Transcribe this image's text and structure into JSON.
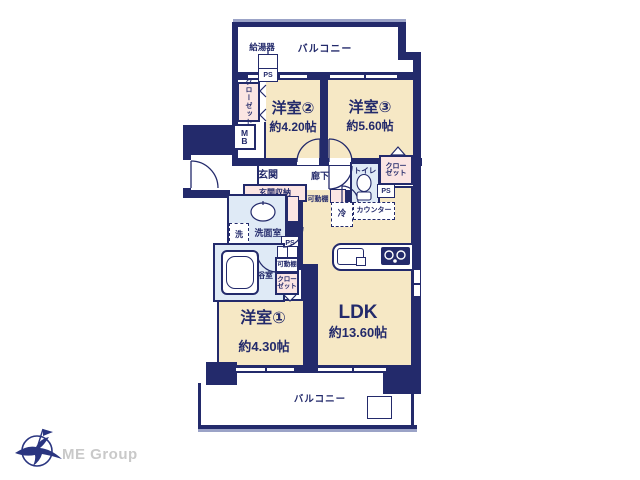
{
  "colors": {
    "wall_navy": "#232a6b",
    "room_beige": "#f6e8c5",
    "closet_pink": "#fbe5e3",
    "wet_blue": "#dfeaf6",
    "rail_gray": "#9ba3c7",
    "logo_text_gray": "#c9c9c9"
  },
  "plan": {
    "balcony_top_label": "バルコニー",
    "balcony_bottom_label": "バルコニー",
    "water_heater_label": "給湯器",
    "ps_top": "PS",
    "ps_right": "PS",
    "ps_washroom": "PS",
    "mb_lines": [
      "M",
      "B"
    ],
    "closet_left_lines": [
      "クロー",
      "ゼット"
    ],
    "closet_right_lines": [
      "クロー",
      "ゼット"
    ],
    "closet_bath_lines": [
      "クロー",
      "ゼット"
    ],
    "rooms": {
      "bedroom2": {
        "name": "洋室②",
        "area": "約4.20帖"
      },
      "bedroom3": {
        "name": "洋室③",
        "area": "約5.60帖"
      },
      "bedroom1": {
        "name": "洋室①",
        "area": "約4.30帖"
      },
      "ldk": {
        "name": "LDK",
        "area": "約13.60帖"
      }
    },
    "entrance_label": "玄関",
    "hallway_label": "廊下",
    "toilet_label": "トイレ",
    "entrance_storage_label": "玄関収納",
    "movable_shelf_hall_label": "可動棚",
    "movable_shelf_bath_label": "可動棚",
    "fridge_label": "冷",
    "counter_label": "カウンター",
    "washer_label": "洗",
    "washroom_label": "洗面室",
    "bathroom_label": "浴室"
  },
  "logo": {
    "text": "ME Group"
  }
}
